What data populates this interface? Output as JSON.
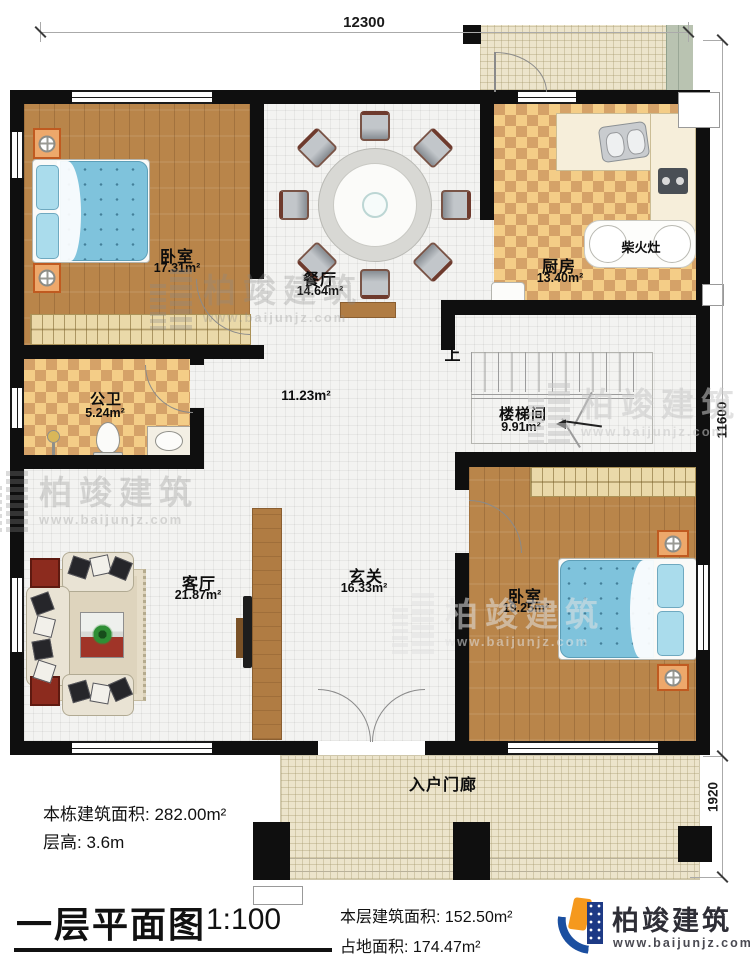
{
  "dims": {
    "top": "12300",
    "right": "11600",
    "right_lower": "1920"
  },
  "rooms": {
    "bedroom1": {
      "name": "卧室",
      "area": "17.31m²"
    },
    "dining": {
      "name": "餐厅",
      "area": "14.64m²"
    },
    "kitchen": {
      "name": "厨房",
      "area": "13.40m²"
    },
    "stove": {
      "name": "柴火灶"
    },
    "bath": {
      "name": "公卫",
      "area": "5.24m²"
    },
    "hall": {
      "area": "11.23m²"
    },
    "stairwell": {
      "name": "楼梯间",
      "area": "9.91m²",
      "up": "上"
    },
    "living": {
      "name": "客厅",
      "area": "21.87m²"
    },
    "foyer": {
      "name": "玄关",
      "area": "16.33m²"
    },
    "bedroom2": {
      "name": "卧室",
      "area": "19.25m²"
    },
    "porch": {
      "name": "入户门廊"
    }
  },
  "notes": {
    "building_area_label": "本栋建筑面积:",
    "building_area_value": "282.00m²",
    "floor_height_label": "层高:",
    "floor_height_value": "3.6m"
  },
  "titleblock": {
    "title": "一层平面图",
    "scale": "1:100",
    "floor_area_label": "本层建筑面积:",
    "floor_area_value": "152.50m²",
    "land_area_label": "占地面积:",
    "land_area_value": "174.47m²"
  },
  "brand": {
    "name": "柏竣建筑",
    "website": "www.baijunjz.com"
  },
  "watermark": {
    "name": "柏竣建筑",
    "website": "www.baijunjz.com"
  },
  "colors": {
    "wall": "#0f0f0f",
    "wood_floor": "#b9854a",
    "checker_light": "#f4cd87",
    "checker_dark": "#d5a268",
    "bed_blue": "#7fc3dc",
    "nightstand_orange": "#eda86b",
    "logo_blue": "#1b4fa0",
    "logo_orange": "#f5991e",
    "sofa_beige": "#e9e3d4",
    "accent_red": "#8c2b1e"
  }
}
